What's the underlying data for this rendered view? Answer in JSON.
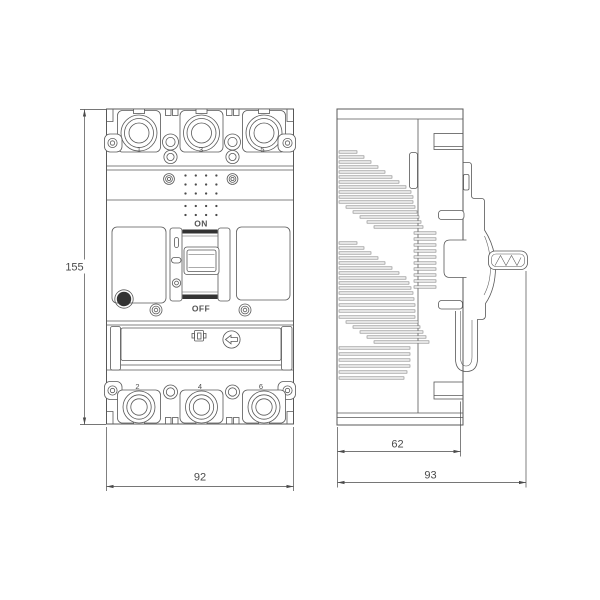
{
  "front_view": {
    "terminals_top": [
      "1",
      "3",
      "5"
    ],
    "terminals_bottom": [
      "2",
      "4",
      "6"
    ],
    "on_label": "ON",
    "off_label": "OFF"
  },
  "dimensions": {
    "overall_height_mm": "155",
    "front_width_mm": "92",
    "body_depth_mm": "62",
    "total_depth_mm": "93"
  },
  "colors": {
    "line": "#585858",
    "dark": "#333333",
    "slat_fill": "#ececec",
    "dimension": "#4a4a4a"
  }
}
